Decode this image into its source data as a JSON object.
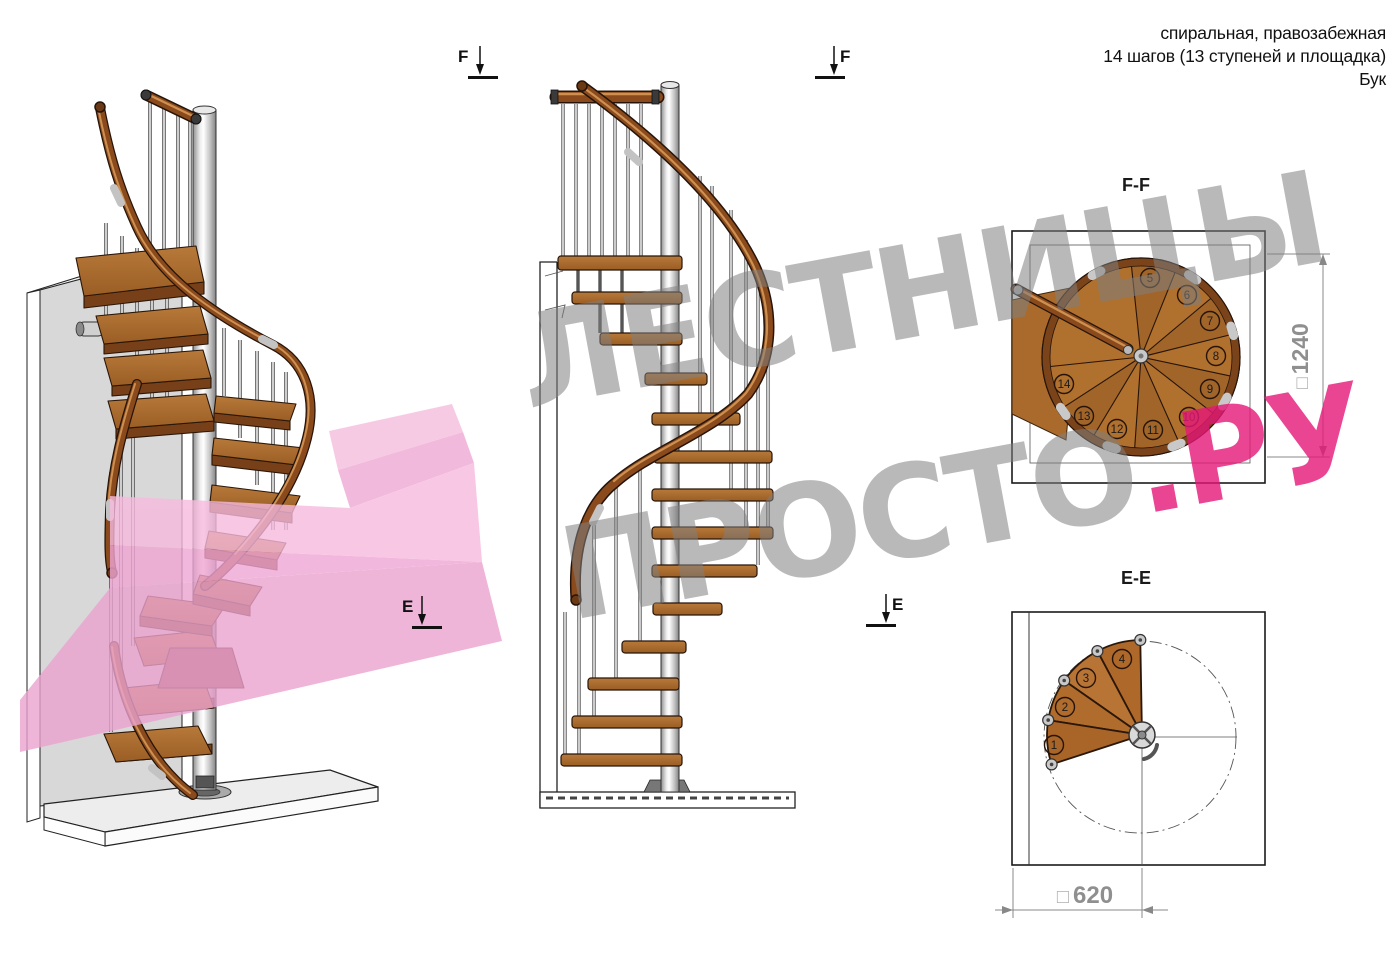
{
  "header": {
    "line1": "спиральная, правозабежная",
    "line2": "14 шагов (13 ступеней и площадка)",
    "line3": "Бук"
  },
  "views": {
    "ff": {
      "title": "F-F",
      "dimension": {
        "symbol": "□",
        "value": "1240"
      },
      "step_numbers": [
        "5",
        "6",
        "7",
        "8",
        "9",
        "10",
        "11",
        "12",
        "13",
        "14"
      ]
    },
    "ee": {
      "title": "E-E",
      "dimension": {
        "symbol": "□",
        "value": "620"
      },
      "step_numbers": [
        "1",
        "2",
        "3",
        "4"
      ]
    }
  },
  "section_markers": {
    "f": "F",
    "e": "E"
  },
  "watermark": {
    "line1": "ЛЕСТНИЦЫ",
    "line2_gray": "ПРОСТО",
    "line2_pink": ".РУ"
  },
  "colors": {
    "wood": "#a96a2c",
    "wood_dark": "#6b3a14",
    "handrail": "#8a4a1c",
    "metal": "#c9c9c9",
    "wall": "#d8d8d8",
    "watermark_gray": "#808080",
    "watermark_pink": "#e51777",
    "dimension_gray": "#8f8f8f"
  }
}
